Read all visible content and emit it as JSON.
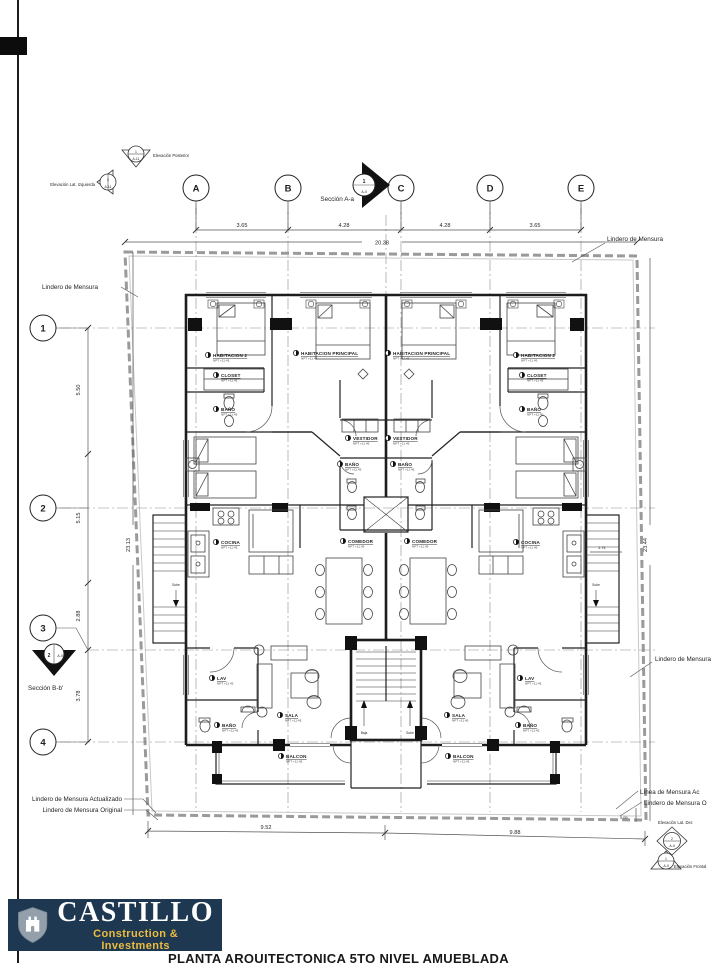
{
  "grid": {
    "cols": [
      "A",
      "B",
      "C",
      "D",
      "E"
    ],
    "rows": [
      "1",
      "2",
      "3",
      "4"
    ]
  },
  "dimensions": {
    "top": [
      "3.65",
      "4.28",
      "4.28",
      "3.65"
    ],
    "top_overall": "20.38",
    "left": [
      "5.50",
      "5.15",
      "2.88",
      "3.78"
    ],
    "left_overall": "23.13",
    "right_overall": "23.44",
    "bottom_left": "9.52",
    "bottom_right": "9.88",
    "offset": "0.09",
    "stair": "1.74"
  },
  "annotations": {
    "lindero_de_mensura": "Lindero de Mensura",
    "lindero_actualizado": "Lindero de Mensura Actualizado",
    "lindero_original": "Lindero de Mensura Original",
    "linea_mensura_act": "Línea de Mensura Ac",
    "lindero_mensura_o": "Lindero de Mensura O",
    "seccion_a": "Sección A-a",
    "seccion_b": "Sección B-b'",
    "elev_posterior": "Elevación Posterior",
    "elev_lat_izq": "Elevación Lat. Izquierda",
    "elev_lat_der": "Elevación Lat. Der.",
    "elev_frontal": "Elevación Frontal",
    "marker_num_1": "1",
    "marker_num_2": "2",
    "marker_sheet": "A-II",
    "marker_sheet_alt": "A-11"
  },
  "plan": {
    "npt_label": "NPT +11.45",
    "stair_labels": {
      "sube": "Sube",
      "baja": "Baja"
    },
    "room_labels": [
      {
        "text": "HABITACION 2",
        "x": 213,
        "y": 357
      },
      {
        "text": "CLOSET",
        "x": 221,
        "y": 377
      },
      {
        "text": "BAÑO",
        "x": 221,
        "y": 411
      },
      {
        "text": "HABITACION PRINCIPAL",
        "x": 301,
        "y": 355
      },
      {
        "text": "VESTIDOR",
        "x": 353,
        "y": 440
      },
      {
        "text": "BAÑO",
        "x": 345,
        "y": 466
      },
      {
        "text": "COCINA",
        "x": 221,
        "y": 544
      },
      {
        "text": "COMEDOR",
        "x": 348,
        "y": 543
      },
      {
        "text": "LAV",
        "x": 217,
        "y": 680
      },
      {
        "text": "BAÑO",
        "x": 222,
        "y": 727
      },
      {
        "text": "SALA",
        "x": 285,
        "y": 717
      },
      {
        "text": "BALCON",
        "x": 286,
        "y": 758
      },
      {
        "text": "HABITACION PRINCIPAL",
        "x": 393,
        "y": 355
      },
      {
        "text": "HABITACION 2",
        "x": 521,
        "y": 357
      },
      {
        "text": "CLOSET",
        "x": 527,
        "y": 377
      },
      {
        "text": "BAÑO",
        "x": 527,
        "y": 411
      },
      {
        "text": "VESTIDOR",
        "x": 393,
        "y": 440
      },
      {
        "text": "BAÑO",
        "x": 398,
        "y": 466
      },
      {
        "text": "COMEDOR",
        "x": 412,
        "y": 543
      },
      {
        "text": "COCINA",
        "x": 521,
        "y": 544
      },
      {
        "text": "LAV",
        "x": 525,
        "y": 680
      },
      {
        "text": "BAÑO",
        "x": 523,
        "y": 727
      },
      {
        "text": "SALA",
        "x": 452,
        "y": 717
      },
      {
        "text": "BALCON",
        "x": 453,
        "y": 758
      }
    ]
  },
  "logo": {
    "name": "CASTILLO",
    "tagline": "Construction & Investments",
    "bg_color": "#1d3850",
    "accent_color": "#eebc3f",
    "shield_color": "#93a0ab"
  },
  "title_block": {
    "sheet_title": "PLANTA ARQUITECTONICA 5TO NIVEL AMUEBLADA"
  }
}
